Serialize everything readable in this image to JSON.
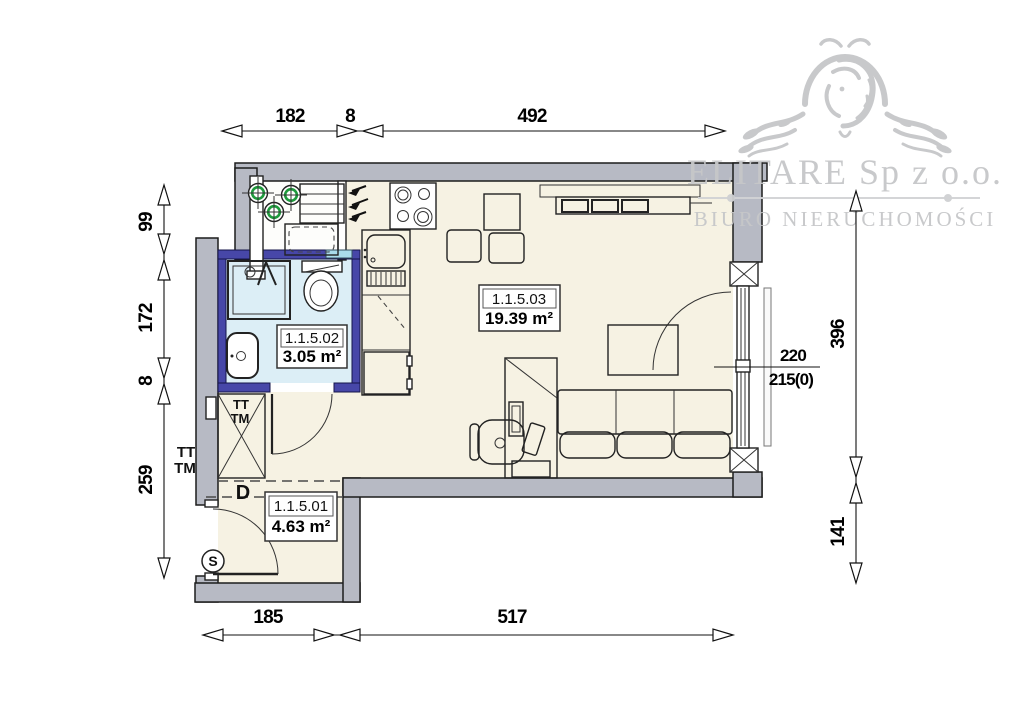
{
  "brand": {
    "company": "ELITARE Sp z o.o.",
    "tagline": "BIURO NIERUCHOMOŚCI"
  },
  "rooms": [
    {
      "id": "1.1.5.01",
      "area": "4.63 m²"
    },
    {
      "id": "1.1.5.02",
      "area": "3.05 m²"
    },
    {
      "id": "1.1.5.03",
      "area": "19.39 m²"
    }
  ],
  "dims": {
    "top": [
      "182",
      "8",
      "492"
    ],
    "left": [
      "99",
      "172",
      "8",
      "259"
    ],
    "right": [
      "396",
      "141"
    ],
    "bottom": [
      "185",
      "517"
    ]
  },
  "window_note": {
    "width": "220",
    "sill": "215(0)"
  },
  "labels": {
    "tt": "TT",
    "tm": "TM",
    "d": "D",
    "s": "S"
  },
  "colors": {
    "wall": "#b7bac4",
    "floor": "#f6f2e3",
    "bath_floor": "#dceef6",
    "bath_wall": "#4747a8",
    "accent_blue": "#a9dcec",
    "pipe_green": "#1f9a3d",
    "logo_gray": "#c6c7c9"
  }
}
